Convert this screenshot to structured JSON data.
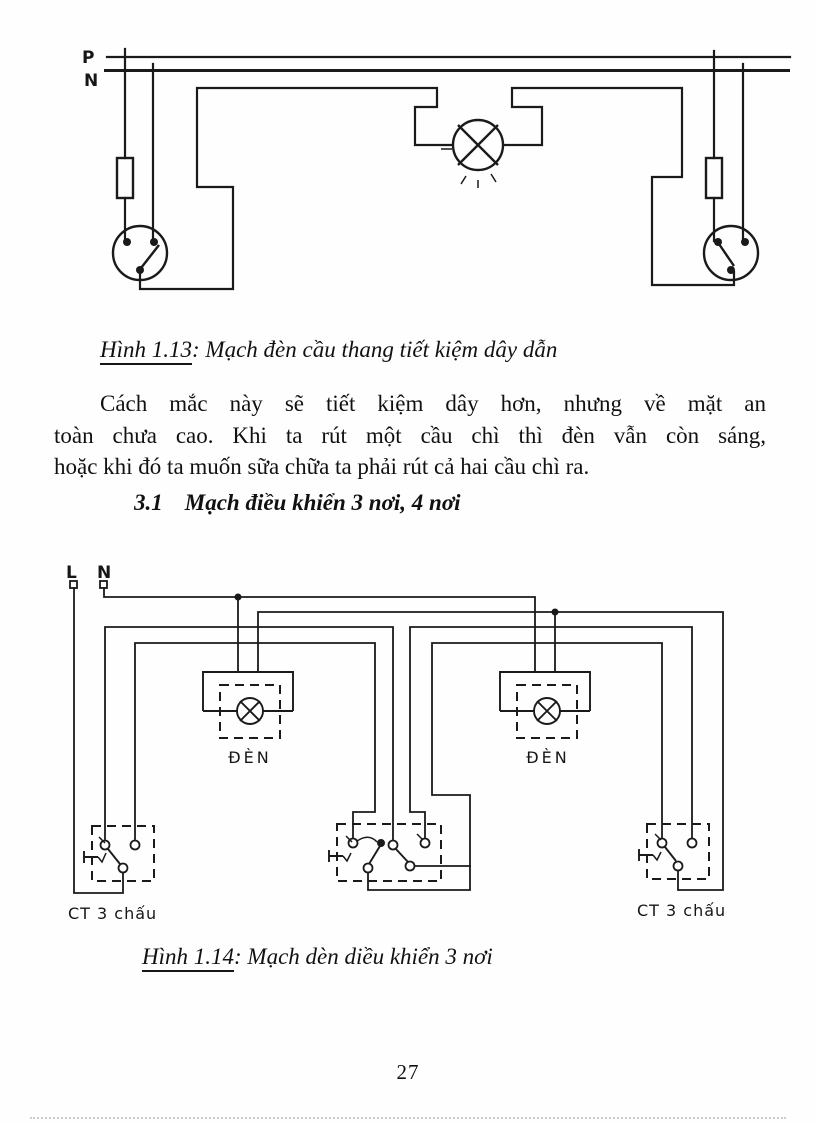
{
  "page": {
    "number": "27"
  },
  "figure_1_13": {
    "labels": {
      "p": "P",
      "n": "N"
    },
    "caption": {
      "ref": "Hình 1.13",
      "text": ": Mạch đèn cầu thang tiết kiệm dây dẫn"
    }
  },
  "paragraph": {
    "lines": [
      "Cách mắc này sẽ tiết kiệm dây hơn, nhưng về mặt an",
      "toàn chưa cao. Khi ta rút một cầu chì thì đèn vẫn còn sáng,",
      "hoặc khi đó ta muốn sữa chữa ta phải rút cả hai cầu chì ra."
    ]
  },
  "section_heading": {
    "number": "3.1",
    "title": "Mạch điều khiển 3 nơi, 4 nơi"
  },
  "figure_1_14": {
    "labels": {
      "l": "L",
      "n": "N",
      "lamp_left": "ĐÈN",
      "lamp_right": "ĐÈN",
      "switch_left": "CT 3 chấu",
      "switch_right": "CT 3 chấu"
    },
    "caption": {
      "ref": "Hình 1.14",
      "text": ": Mạch dèn diều khiển 3 nơi"
    }
  }
}
